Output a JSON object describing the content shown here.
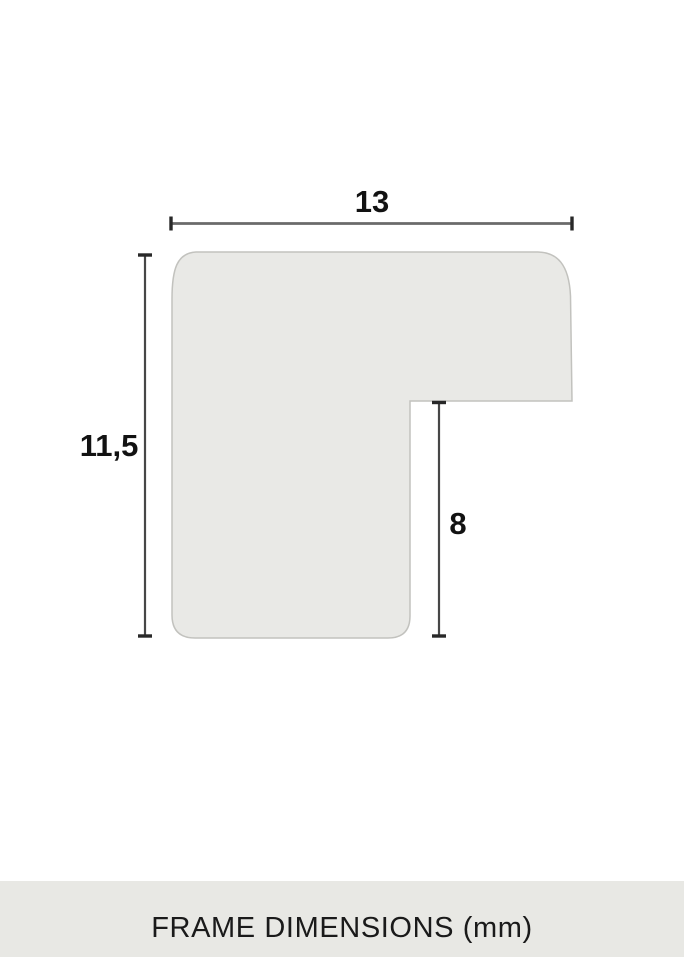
{
  "diagram": {
    "title": "frame moulding profile cross-section",
    "width_label": "13",
    "height_label": "11,5",
    "rabbet_label": "8"
  },
  "caption": {
    "title": "FRAME DIMENSIONS (mm)"
  },
  "colors": {
    "page_background": "#ffffff",
    "profile_fill": "#e9e9e6",
    "profile_stroke": "#c2c2be",
    "dimension_line": "#5f5f5f",
    "dimension_tick": "#282828",
    "label_text": "#121212",
    "caption_background": "#e8e8e4",
    "caption_text": "#1a1a1a"
  }
}
